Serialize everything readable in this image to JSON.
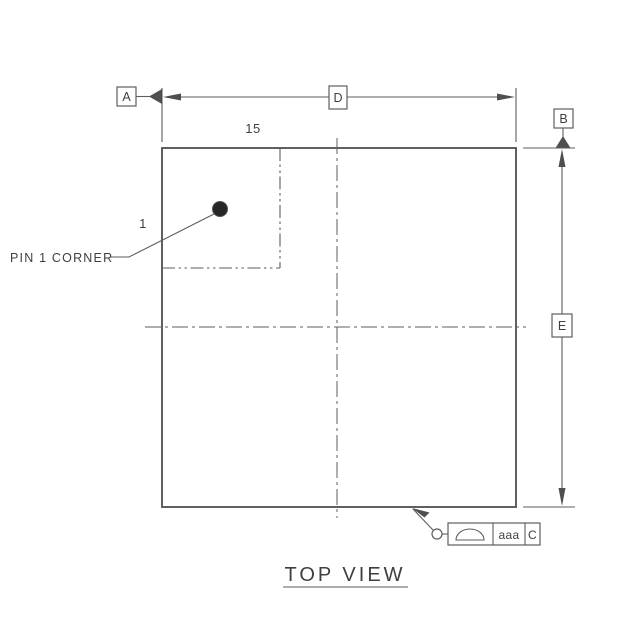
{
  "drawing": {
    "view_title": "TOP VIEW",
    "labels": {
      "pin1_note": "PIN 1 CORNER",
      "pin_count_top": "15",
      "pin_first_side": "1"
    },
    "datums": {
      "a": "A",
      "b": "B"
    },
    "dimensions": {
      "width_label": "D",
      "height_label": "E"
    },
    "feature_control_frame": {
      "symbol": "profile-of-a-surface",
      "tolerance": "aaa",
      "datum_ref": "C"
    },
    "colors": {
      "line": "#4f4f4f",
      "thin": "#5e5e5e",
      "text": "#3f3f3f",
      "pin1": "#262626",
      "bg": "#ffffff"
    }
  }
}
